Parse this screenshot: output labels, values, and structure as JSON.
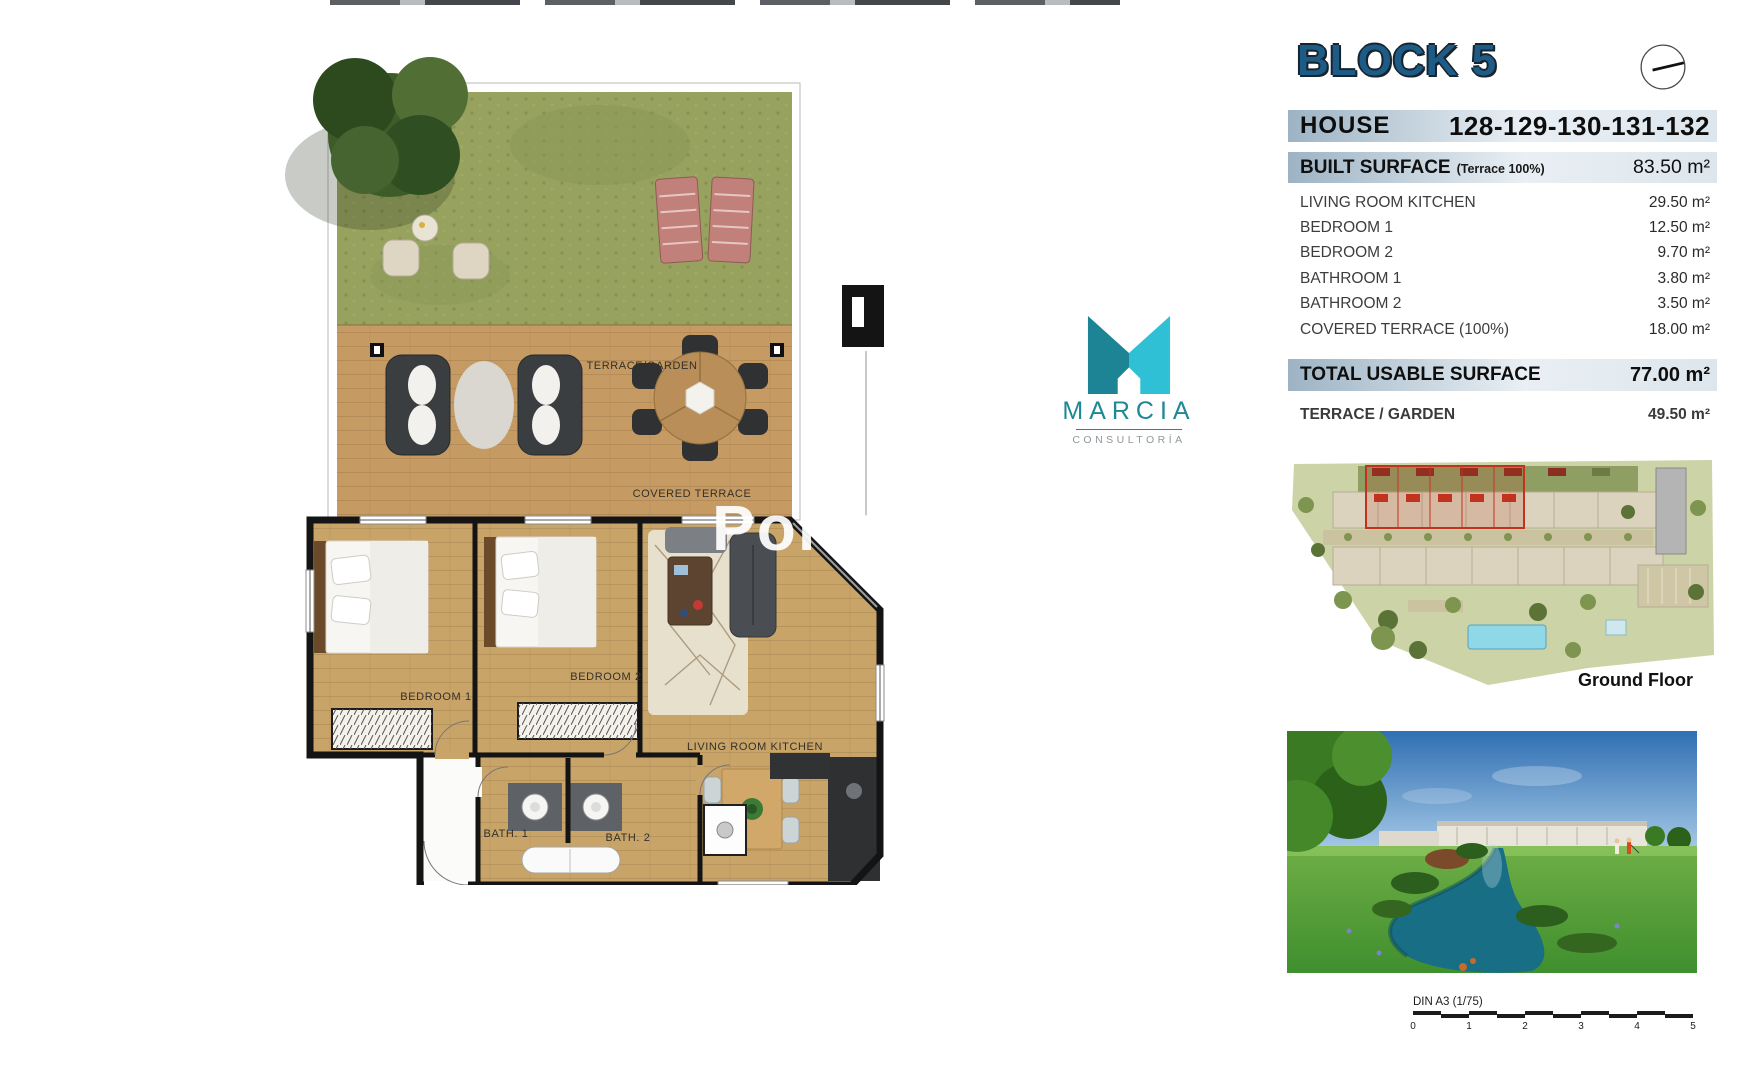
{
  "header": {
    "block_title": "BLOCK 5"
  },
  "house": {
    "label": "HOUSE",
    "numbers": "128-129-130-131-132"
  },
  "built_surface": {
    "label": "BUILT SURFACE",
    "note": "(Terrace 100%)",
    "value": "83.50 m²"
  },
  "rooms": [
    {
      "label": "LIVING ROOM KITCHEN",
      "value": "29.50 m²"
    },
    {
      "label": "BEDROOM 1",
      "value": "12.50 m²"
    },
    {
      "label": "BEDROOM 2",
      "value": "9.70 m²"
    },
    {
      "label": "BATHROOM 1",
      "value": "3.80 m²"
    },
    {
      "label": "BATHROOM 2",
      "value": "3.50 m²"
    },
    {
      "label": "COVERED TERRACE (100%)",
      "value": "18.00 m²"
    }
  ],
  "total": {
    "label": "TOTAL USABLE SURFACE",
    "value": "77.00 m²"
  },
  "terrace_row": {
    "label": "TERRACE / GARDEN",
    "value": "49.50 m²"
  },
  "site_plan": {
    "caption": "Ground Floor"
  },
  "scale_bar": {
    "label": "DIN A3 (1/75)",
    "ticks": [
      "0",
      "1",
      "2",
      "3",
      "4",
      "5"
    ]
  },
  "logo": {
    "name": "MARCIA",
    "subtitle": "CONSULTORÍA"
  },
  "floorplan": {
    "labels": {
      "terrace_garden": "TERRACE/GARDEN",
      "covered_terrace": "COVERED TERRACE",
      "bedroom1": "BEDROOM 1",
      "bedroom2": "BEDROOM 2",
      "living": "LIVING ROOM KITCHEN",
      "bath1": "BATH. 1",
      "bath2": "BATH. 2"
    },
    "watermark": "Porta"
  },
  "colors": {
    "heading_blue": "#1d5c87",
    "teal_dark": "#1C8494",
    "teal_light": "#2FC0D5",
    "bar_blue": "#9db3c4",
    "highlight_red": "#C2331E"
  }
}
